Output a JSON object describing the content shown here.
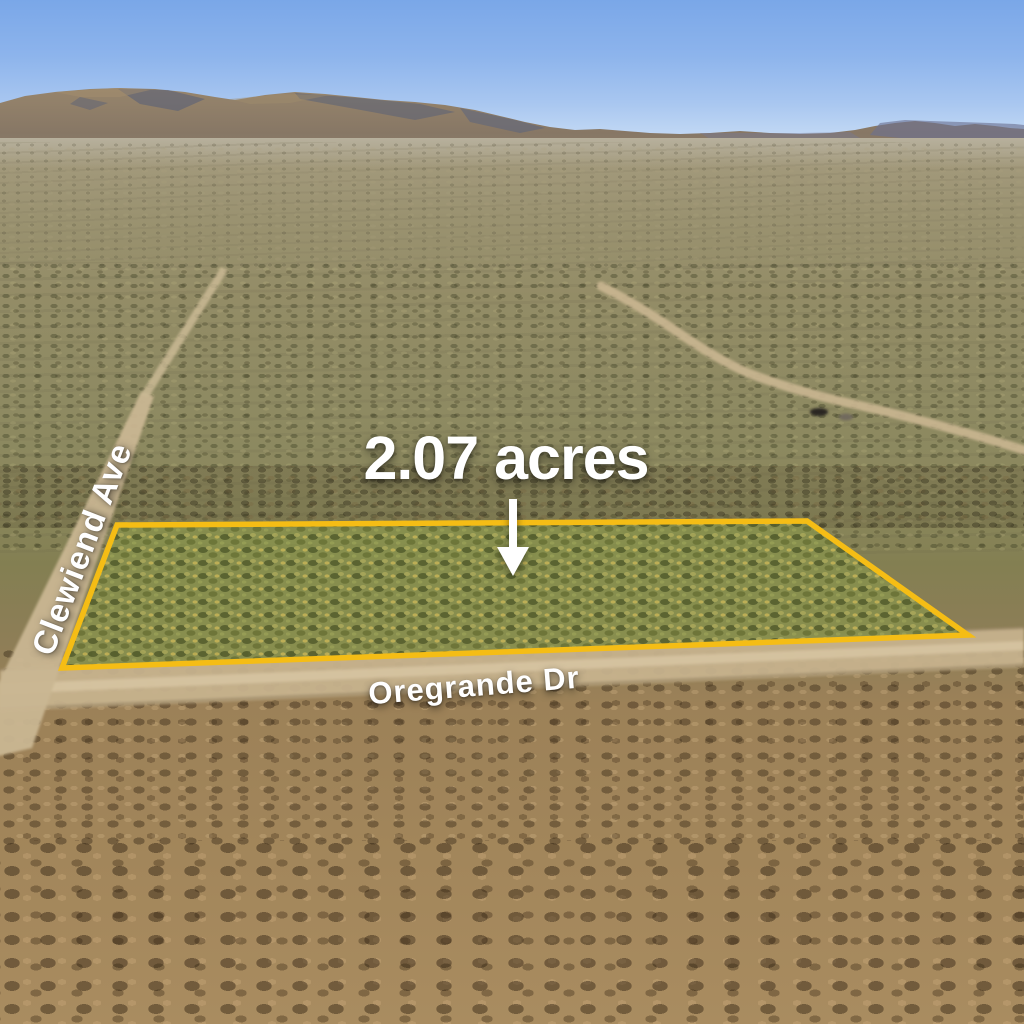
{
  "scene": {
    "description": "Oblique aerial photograph of a desert land parcel for sale, outlined in yellow, with mountain range on the horizon",
    "parcel": {
      "acreage_label": "2.07 acres",
      "boundary_color": "#F5BD15",
      "interior_color": "#87904E"
    },
    "streets": [
      {
        "name": "Clewiend Ave"
      },
      {
        "name": "Oregrande Dr"
      }
    ],
    "annotations": {
      "arrow": "down-arrow pointing from acreage label into parcel",
      "label_text_color": "#FFFFFF"
    },
    "colors": {
      "sky_top": "#7AA7E8",
      "sky_horizon": "#D9E7F8",
      "mountain": "#8A7965",
      "mountain_shadow": "#4E5A7A",
      "terrain_far": "#A69C80",
      "terrain_mid": "#8E8A62",
      "terrain_foreground": "#A98C60",
      "dirt_road": "#C6B28D"
    }
  }
}
